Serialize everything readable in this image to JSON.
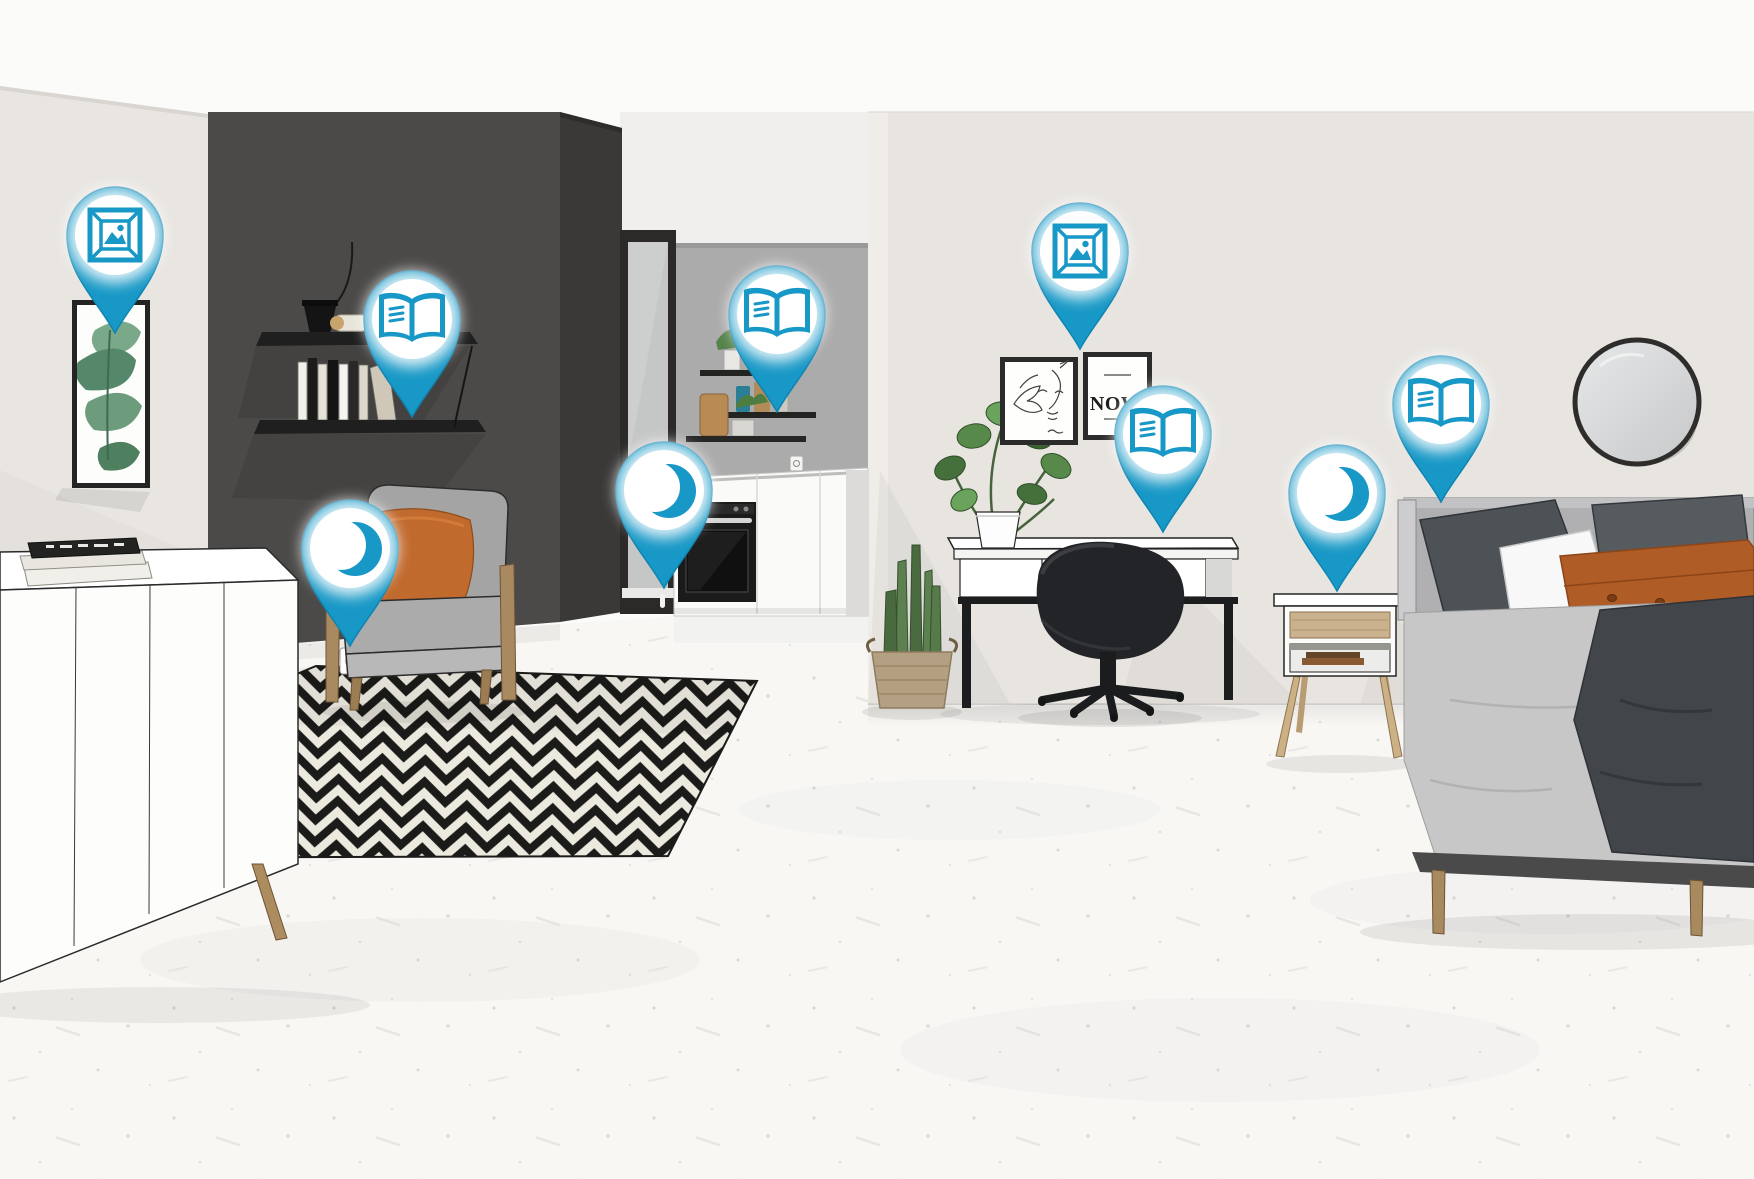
{
  "scene": {
    "name": "interactive-apartment-scene",
    "artwork": {
      "print_text": "NOW."
    }
  },
  "colors": {
    "pin": "#1798c6",
    "pin_edge": "#0d84b2",
    "wall_light": "#e8e5e1",
    "wall_dark": "#4b4a49",
    "wall_dark_side": "#3a3938",
    "kitchen_wall": "#acabab",
    "floor": "#f8f7f4",
    "rug_black": "#1b1b19",
    "rug_white": "#eceadf",
    "accent_orange": "#c06a2d"
  },
  "hotspots": [
    {
      "id": "hotspot-1",
      "icon": "picture-frame",
      "x": 115,
      "y": 333,
      "location": "living-room-wall-art"
    },
    {
      "id": "hotspot-2",
      "icon": "open-book",
      "x": 412,
      "y": 417,
      "location": "living-room-shelf"
    },
    {
      "id": "hotspot-3",
      "icon": "moon",
      "x": 350,
      "y": 646,
      "location": "living-room-armchair"
    },
    {
      "id": "hotspot-4",
      "icon": "moon",
      "x": 664,
      "y": 588,
      "location": "kitchen-doorway"
    },
    {
      "id": "hotspot-5",
      "icon": "open-book",
      "x": 777,
      "y": 412,
      "location": "kitchen-shelves"
    },
    {
      "id": "hotspot-6",
      "icon": "picture-frame",
      "x": 1080,
      "y": 349,
      "location": "bedroom-wall-art"
    },
    {
      "id": "hotspot-7",
      "icon": "open-book",
      "x": 1163,
      "y": 532,
      "location": "desk"
    },
    {
      "id": "hotspot-8",
      "icon": "moon",
      "x": 1337,
      "y": 591,
      "location": "nightstand"
    },
    {
      "id": "hotspot-9",
      "icon": "open-book",
      "x": 1441,
      "y": 502,
      "location": "bed"
    }
  ]
}
